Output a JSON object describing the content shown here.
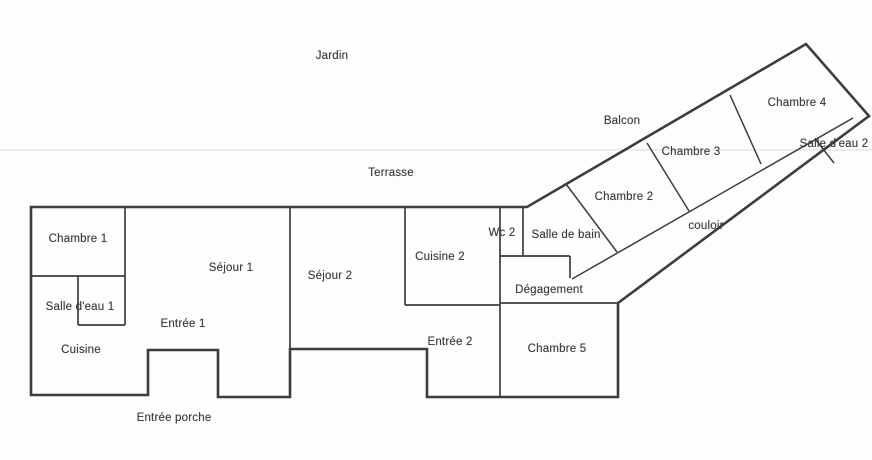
{
  "plan": {
    "outdoor_areas": {
      "jardin": "Jardin",
      "terrasse": "Terrasse",
      "balcon": "Balcon",
      "entree_porche": "Entrée porche"
    },
    "rooms": {
      "chambre1": "Chambre 1",
      "sejour1": "Séjour 1",
      "salle_deau1": "Salle d'eau 1",
      "entree1": "Entrée 1",
      "cuisine": "Cuisine",
      "sejour2": "Séjour 2",
      "cuisine2": "Cuisine 2",
      "entree2": "Entrée 2",
      "wc2": "Wc 2",
      "salle_de_bain": "Salle de bain",
      "degagement": "Dégagement",
      "chambre5": "Chambre 5",
      "chambre2": "Chambre 2",
      "chambre3": "Chambre 3",
      "chambre4": "Chambre 4",
      "salle_deau2": "Salle d'eau 2",
      "couloir": "couloir"
    },
    "colors": {
      "wall": "#3d3d3d",
      "text": "#3a3a3a",
      "background": "#fdfdfd",
      "terrace_line": "#e0e0e0"
    }
  }
}
